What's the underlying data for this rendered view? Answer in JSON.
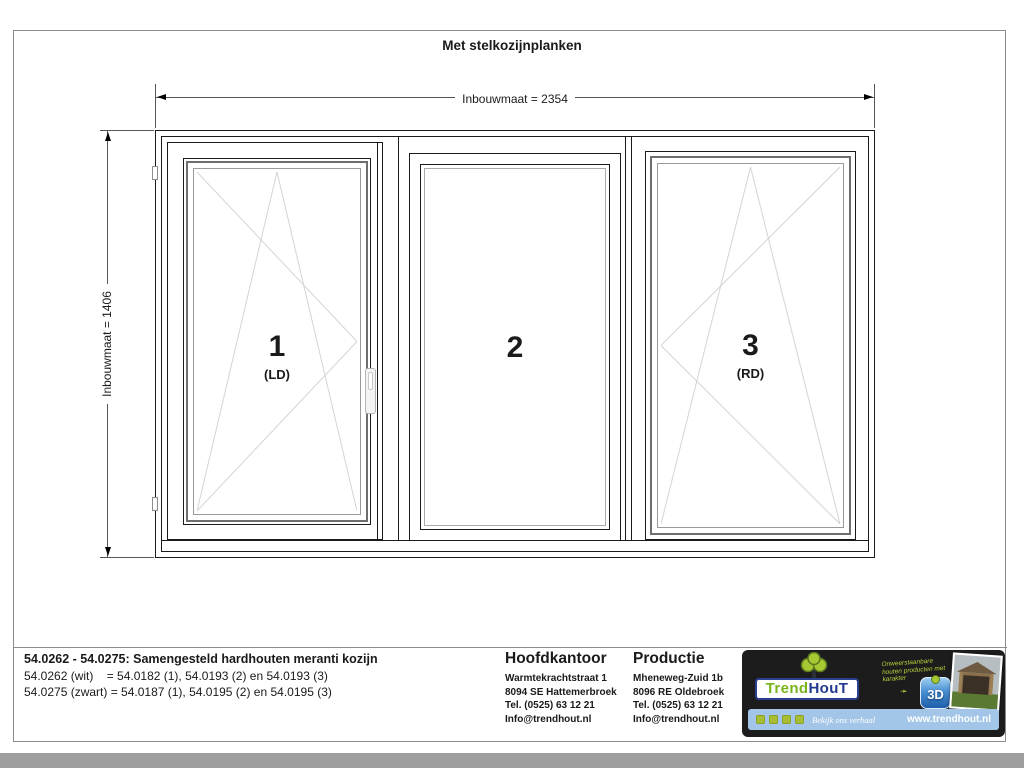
{
  "page": {
    "title": "Met stelkozijnplanken"
  },
  "drawing": {
    "dim_width_label": "Inbouwmaat = 2354",
    "dim_height_label": "Inbouwmaat = 1406",
    "panels": [
      {
        "number": "1",
        "hinge": "(LD)"
      },
      {
        "number": "2",
        "hinge": ""
      },
      {
        "number": "3",
        "hinge": "(RD)"
      }
    ]
  },
  "titleblock": {
    "product_title": "54.0262 - 54.0275: Samengesteld hardhouten meranti kozijn",
    "variant_wit": "54.0262 (wit)    = 54.0182 (1), 54.0193 (2) en 54.0193 (3)",
    "variant_zwart": "54.0275 (zwart) = 54.0187 (1), 54.0195 (2) en 54.0195 (3)",
    "hoofdkantoor": {
      "heading": "Hoofdkantoor",
      "lines": [
        "Warmtekrachtstraat 1",
        "8094 SE Hattemerbroek",
        "Tel. (0525) 63 12 21",
        "Info@trendhout.nl"
      ]
    },
    "productie": {
      "heading": "Productie",
      "lines": [
        "Mheneweg-Zuid 1b",
        "8096 RE Oldebroek",
        "Tel. (0525) 63 12 21",
        "Info@trendhout.nl"
      ]
    },
    "logo": {
      "brand_trend": "Trend",
      "brand_hout": "HouT",
      "slogan": "Onweerstaanbare houten producten met karakter",
      "badge_3d": "3D",
      "tagline": "Bekijk ons verhaal",
      "website": "www.trendhout.nl",
      "colors": {
        "brand_green": "#7ab41d",
        "brand_blue": "#23388f",
        "bar_blue": "#a3c6e8"
      }
    }
  }
}
